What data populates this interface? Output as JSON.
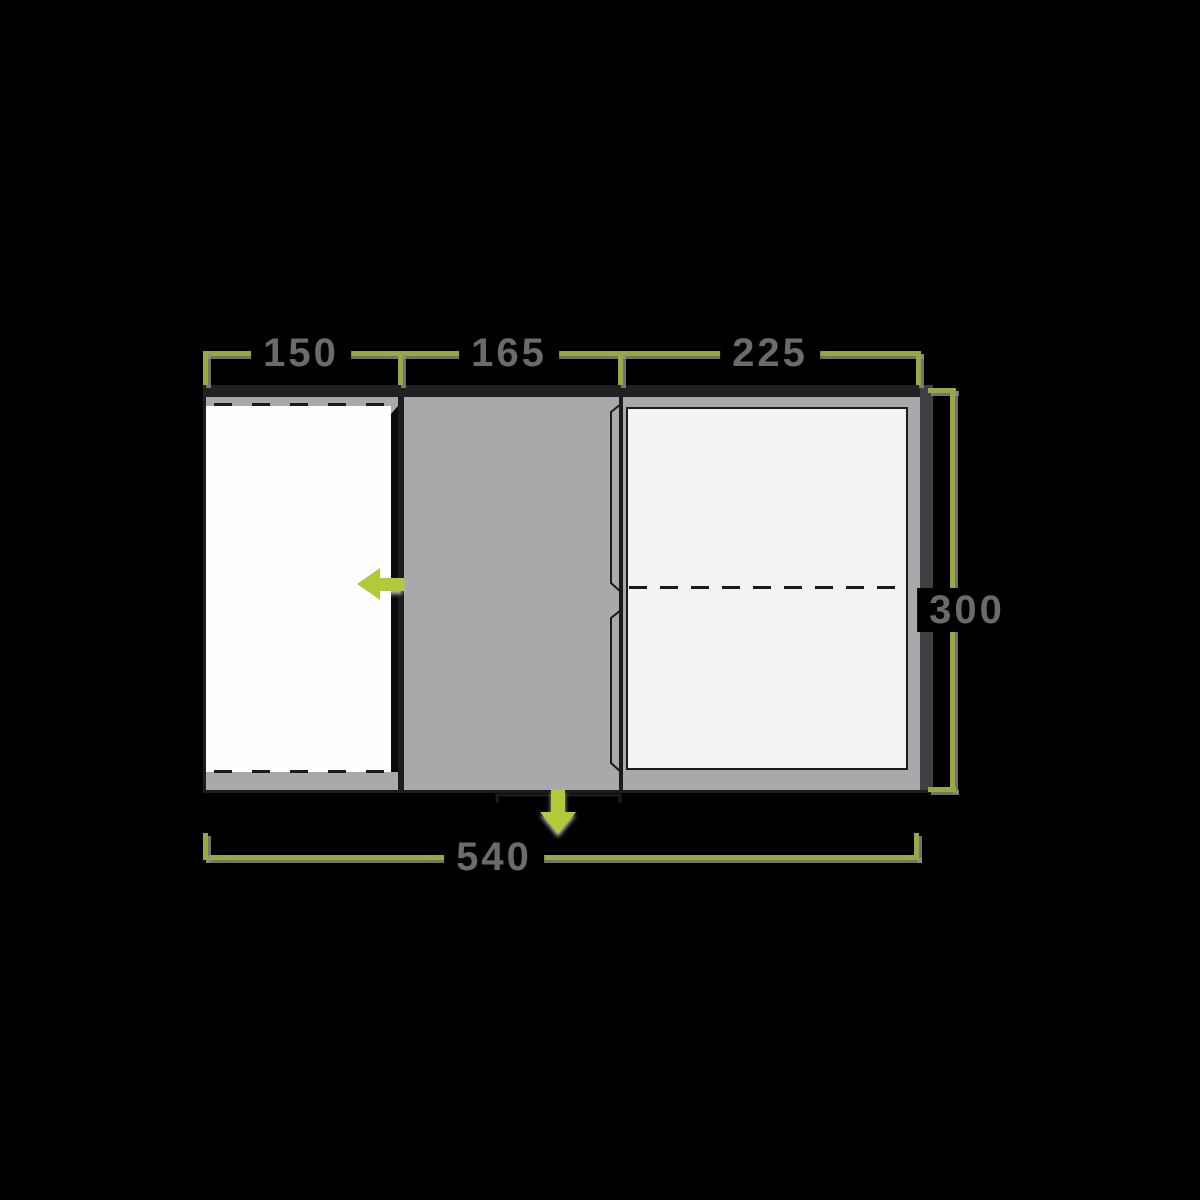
{
  "floorplan": {
    "description": "tent floor plan with dimensions in cm",
    "dimensions": {
      "section_left": "150",
      "section_middle": "165",
      "section_right": "225",
      "depth": "300",
      "total_width": "540"
    },
    "colors": {
      "background": "#000000",
      "dimension_line_green": "#9aa83e",
      "arrow_green": "#b2c93a",
      "label_text_grey": "#6b6b6d",
      "front_wall_dark": "#212123",
      "side_wall_grey": "#3f4043",
      "interior_grey": "#a8a9ab",
      "sleeping_area_white": "#f3f3f5",
      "annex_area_white": "#fefefe"
    },
    "icons": {
      "arrow_left": "annex-entrance-arrow-left-icon",
      "arrow_down": "main-entrance-arrow-down-icon"
    }
  }
}
